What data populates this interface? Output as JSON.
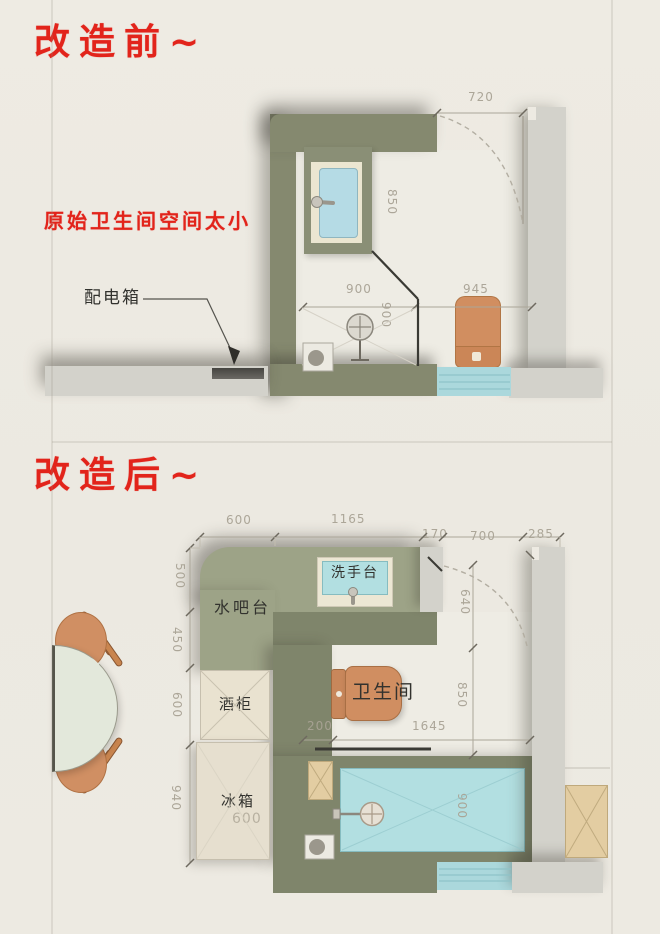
{
  "titles": {
    "before": "改造前~",
    "after": "改造后~"
  },
  "plan_before": {
    "note": "原始卫生间空间太小",
    "distribution_box": "配电箱",
    "dims": {
      "door": "720",
      "vanity": "850",
      "shower_w": "900",
      "shower_d": "900",
      "right": "945"
    }
  },
  "plan_after": {
    "labels": {
      "water_bar": "水吧台",
      "washbasin": "洗手台",
      "wine_cabinet": "酒柜",
      "fridge": "冰箱",
      "bathroom": "卫生间"
    },
    "dims_top": [
      "600",
      "1165",
      "170",
      "700",
      "285"
    ],
    "dims_left": [
      "500",
      "450",
      "600",
      "940"
    ],
    "dims_inner": {
      "door": "640",
      "toilet": "850",
      "gap": "200",
      "length": "1645",
      "shower": "900",
      "fridge": "600"
    }
  },
  "colors": {
    "accent_red": "#e2241b",
    "wall_olive": "#85896f",
    "wall_gray": "#d3d2cb",
    "counter_green": "#9da387",
    "water_teal": "#b2dfe1",
    "furniture_orange": "#d08e61",
    "cabinet_cream": "#e9e2d0",
    "cabinet_tan": "#e3cda2",
    "paper": "#edeae2"
  }
}
